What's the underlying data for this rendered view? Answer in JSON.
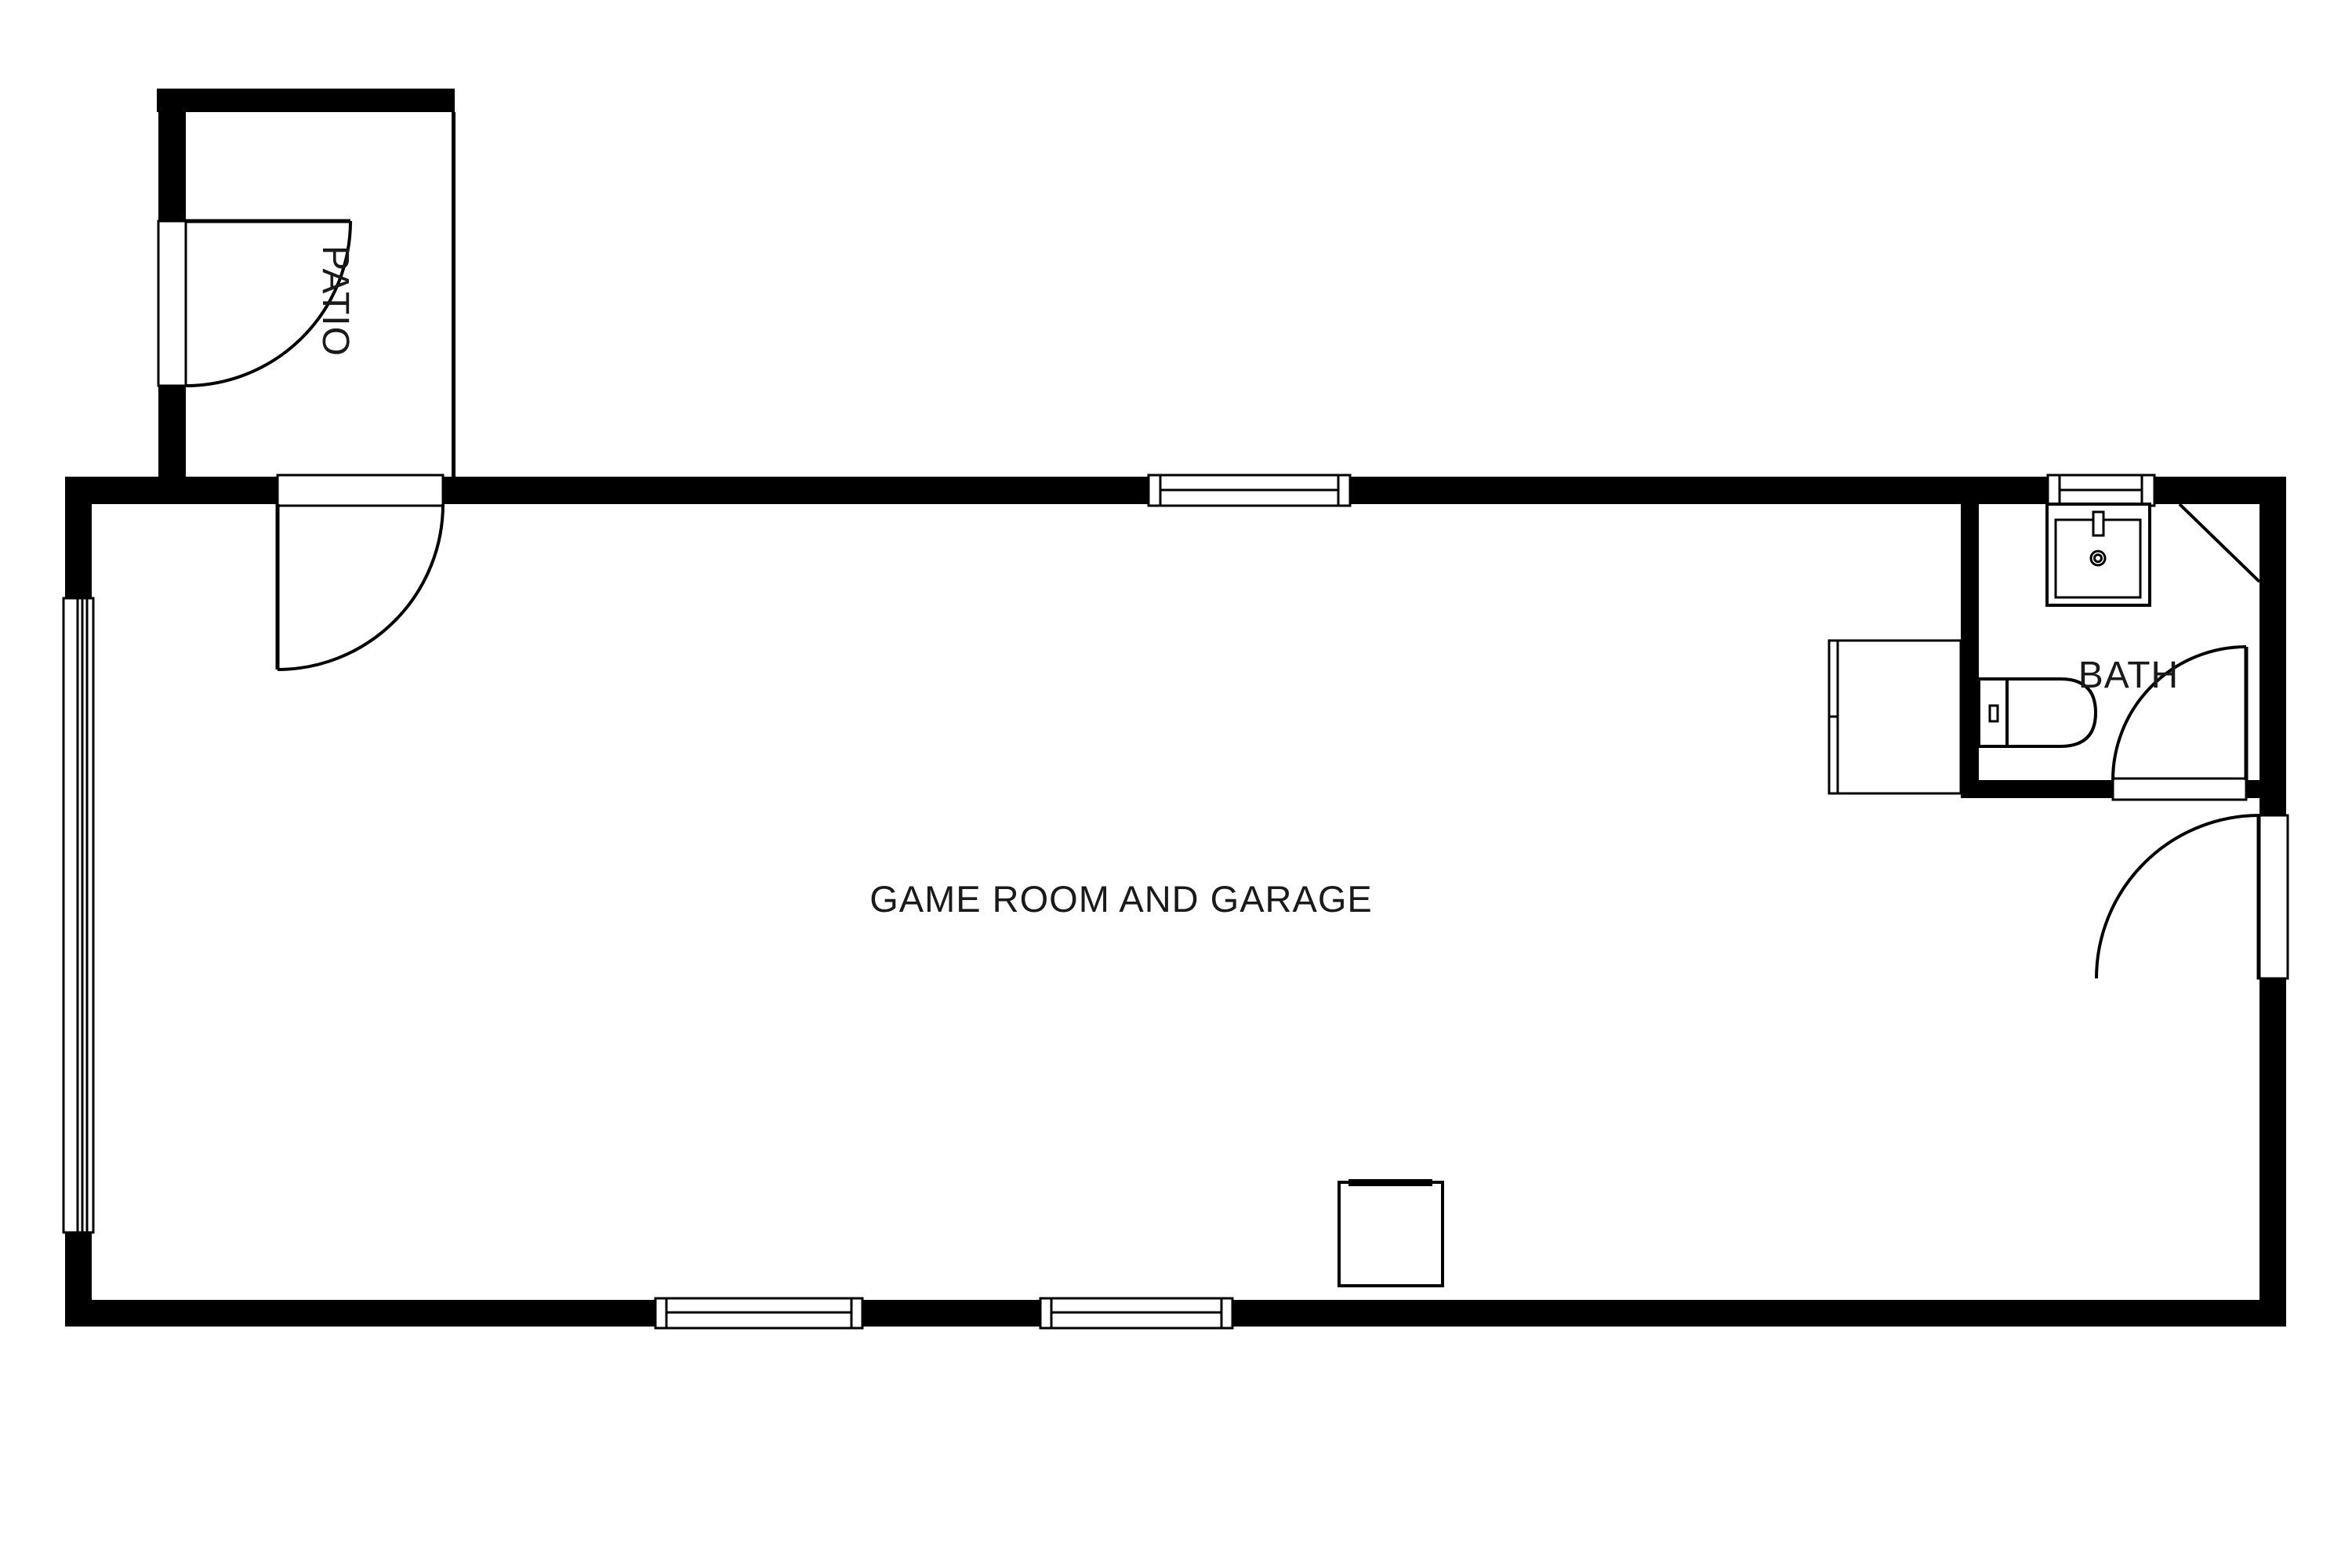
{
  "plan": {
    "title": "Game room and garage floor plan",
    "colors": {
      "walls": "#000000",
      "background": "#ffffff",
      "text": "#1a1a1a"
    },
    "rooms": [
      {
        "id": "game-room",
        "label": "GAME ROOM AND GARAGE"
      },
      {
        "id": "bath",
        "label": "BATH"
      },
      {
        "id": "patio",
        "label": "PATIO"
      }
    ],
    "fixtures": [
      "sink-icon",
      "toilet-icon",
      "closet-cabinet",
      "corner-shelf-diagonal",
      "appliance-square",
      "door-swing-icon",
      "window-icon"
    ],
    "counts": {
      "doors": 4,
      "windows": 5
    }
  }
}
